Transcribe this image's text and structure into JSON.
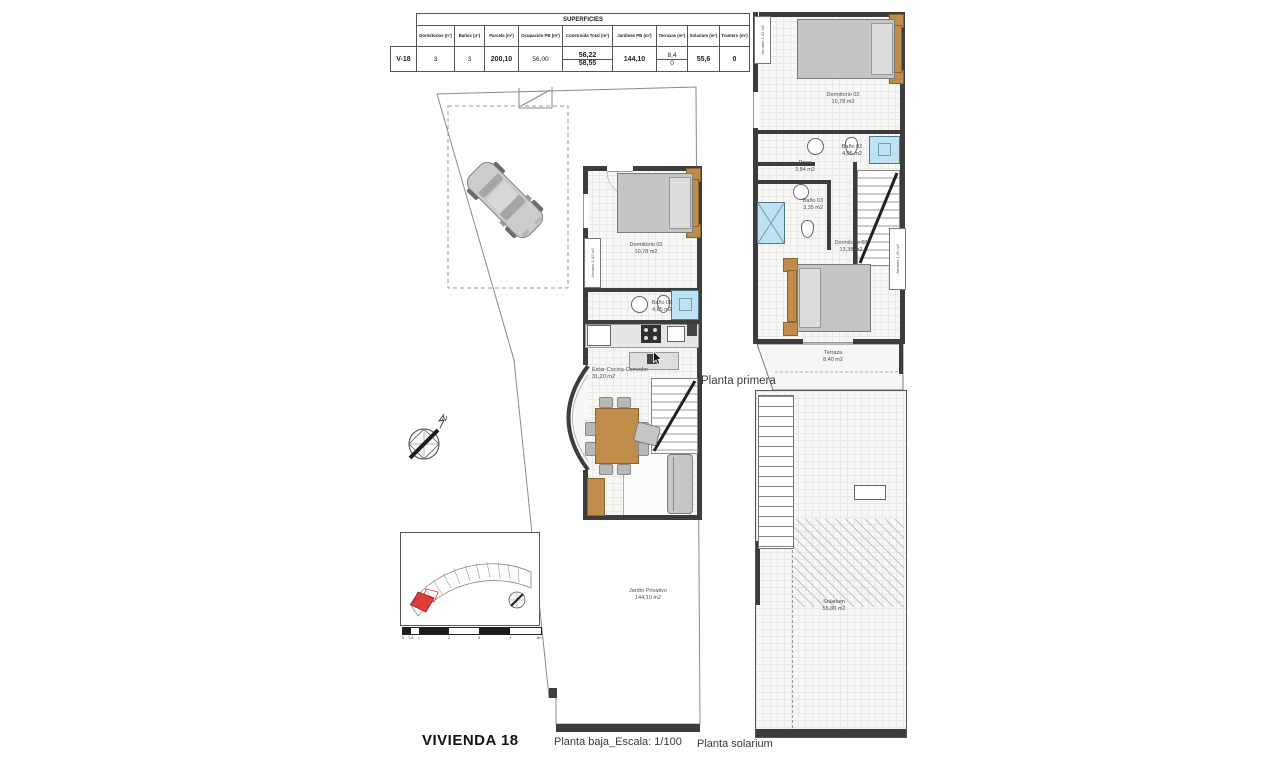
{
  "colors": {
    "wall": "#3d3d3d",
    "wood": "#c08c4a",
    "shower": "#bfe2f2",
    "lot_red": "#e03c3c"
  },
  "table": {
    "title": "SUPERFICIES",
    "row_id": "V-18",
    "columns": [
      "Dormitorios (nº)",
      "Baños (nº)",
      "Parcela (m²)",
      "Ocupación PB (m²)",
      "Construida Total (m²)",
      "Jardines PB (m²)",
      "Terrazas (m²)",
      "Solarium (m²)",
      "Trastero (m²)"
    ],
    "row": {
      "dormitorios": "3",
      "banos": "3",
      "parcela": "200,10",
      "ocupacion_pb": "56,00",
      "construida_total_top": "56,22",
      "construida_total_bottom": "58,55",
      "jardines_pb": "144,10",
      "terrazas_top": "8,4",
      "terrazas_bottom": "0",
      "solarium": "55,6",
      "trastero": "0"
    }
  },
  "ground_floor": {
    "rooms": {
      "dormitorio": {
        "name": "Dormitorio 02",
        "area": "10,78 m2"
      },
      "bano": {
        "name": "Baño 02",
        "area": "4,05 m2"
      },
      "estar": {
        "name": "Estar-Cocina-Comedor",
        "area": "31,20 m2"
      },
      "jardin": {
        "name": "Jardín Privativo",
        "area": "144,10 m2"
      },
      "armario": {
        "name": "Armario",
        "area": "1,42 m2"
      }
    }
  },
  "first_floor": {
    "label": "Planta primera",
    "rooms": {
      "dormitorio2": {
        "name": "Dormitorio 02",
        "area": "10,78 m2"
      },
      "bano2": {
        "name": "Baño 02",
        "area": "4,05 m2"
      },
      "paso": {
        "name": "Paso",
        "area": "3,84 m2"
      },
      "bano3": {
        "name": "Baño 03",
        "area": "3,35 m2"
      },
      "dormitorio3": {
        "name": "Dormitorio 03",
        "area": "13,38 m2"
      },
      "terraza": {
        "name": "Terraza",
        "area": "8,40 m2"
      },
      "armario": {
        "name": "Armario",
        "area": "1,42 m2"
      }
    }
  },
  "solarium_floor": {
    "rooms": {
      "solarium": {
        "name": "Solarium",
        "area": "55,80 m2"
      }
    }
  },
  "compass": {
    "north": "N"
  },
  "scale_bar": {
    "ticks": [
      "0",
      "0,5",
      "1",
      "2",
      "3",
      "4",
      "5m"
    ]
  },
  "footer": {
    "title": "VIVIENDA 18",
    "ground_caption": "Planta baja_Escala: 1/100",
    "solarium_caption": "Planta solarium"
  }
}
